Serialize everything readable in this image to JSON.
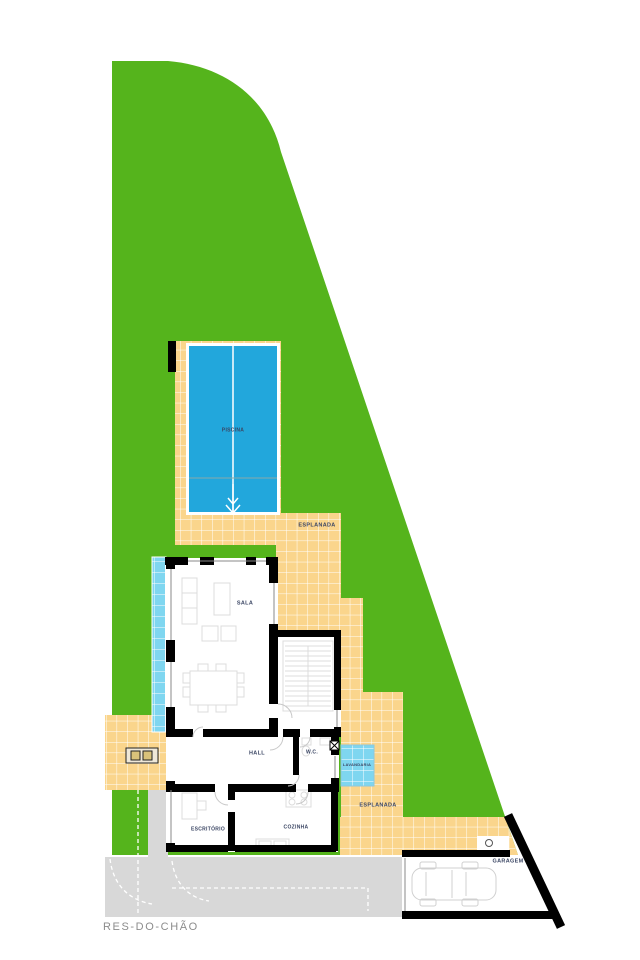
{
  "plan": {
    "title": "RES-DO-CHÃO",
    "floor_labels": [
      {
        "id": "piscina",
        "text": "PISCINA",
        "x": 233,
        "y": 430,
        "size": 5
      },
      {
        "id": "esplanada-upper",
        "text": "ESPLANADA",
        "x": 317,
        "y": 525,
        "size": 5.5
      },
      {
        "id": "sala",
        "text": "SALA",
        "x": 245,
        "y": 603,
        "size": 5.5
      },
      {
        "id": "hall",
        "text": "HALL",
        "x": 257,
        "y": 753,
        "size": 5.5
      },
      {
        "id": "wc",
        "text": "W.C.",
        "x": 312,
        "y": 752,
        "size": 5
      },
      {
        "id": "lavandaria",
        "text": "LAVANDARIA",
        "x": 357,
        "y": 765,
        "size": 4
      },
      {
        "id": "esplanada-lower",
        "text": "ESPLANADA",
        "x": 378,
        "y": 805,
        "size": 5.5
      },
      {
        "id": "escritorio",
        "text": "ESCRITÓRIO",
        "x": 208,
        "y": 829,
        "size": 5
      },
      {
        "id": "cozinha",
        "text": "COZINHA",
        "x": 296,
        "y": 827,
        "size": 5
      },
      {
        "id": "garagem",
        "text": "GARAGEM",
        "x": 508,
        "y": 861,
        "size": 5.5
      }
    ]
  },
  "colors": {
    "lawn": "#55B41C",
    "tile": "#FAD58C",
    "tile_grid": "#FFFFFF",
    "pool": "#22A7DC",
    "water_light": "#7FD6F0",
    "pavement": "#D8D8D8",
    "wall": "#000000",
    "furniture": "#DCDCDC",
    "label": "#3A4563",
    "title": "#8C8C8C"
  }
}
